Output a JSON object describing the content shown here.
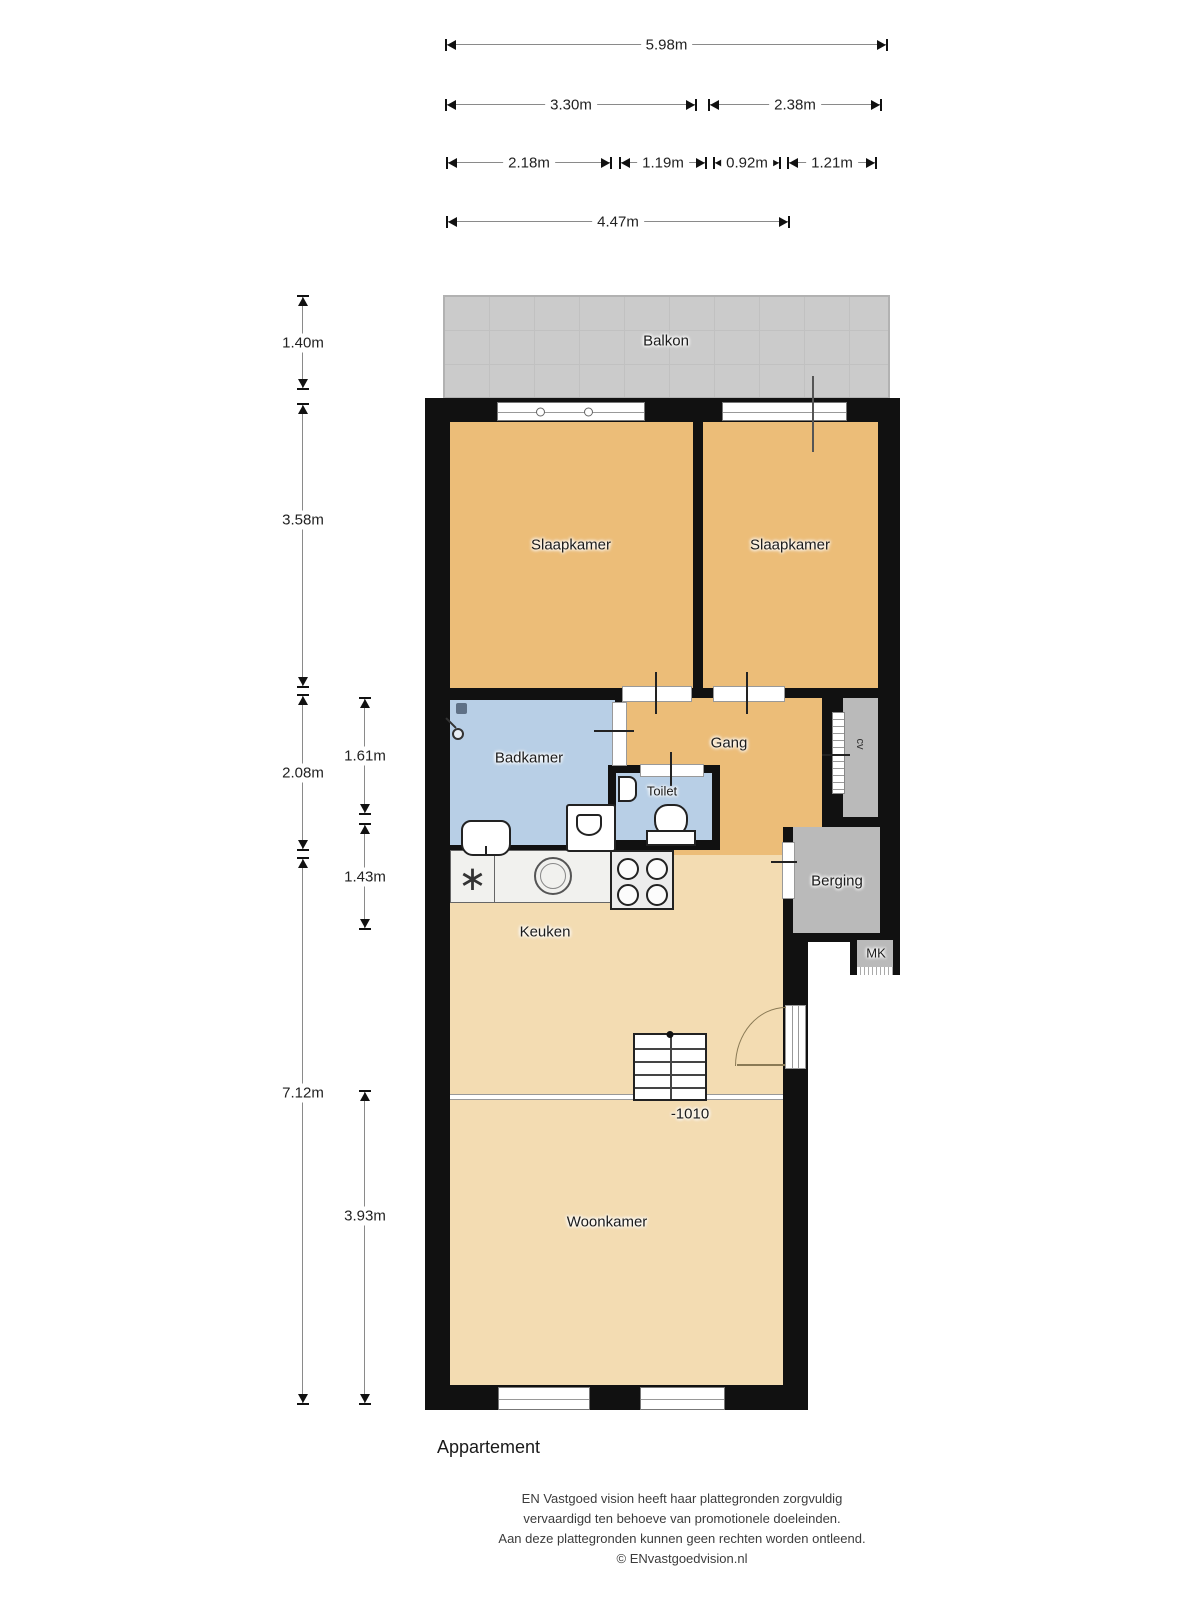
{
  "dimensions": {
    "top": [
      "5.98m",
      "3.30m",
      "2.38m",
      "2.18m",
      "1.19m",
      "0.92m",
      "1.21m",
      "4.47m"
    ],
    "left": [
      "1.40m",
      "3.58m",
      "2.08m",
      "7.12m"
    ],
    "left_inner": [
      "1.61m",
      "1.43m",
      "3.93m"
    ]
  },
  "rooms": {
    "balkon": "Balkon",
    "slaapkamer_left": "Slaapkamer",
    "slaapkamer_right": "Slaapkamer",
    "badkamer": "Badkamer",
    "toilet": "Toilet",
    "gang": "Gang",
    "cv": "cv",
    "berging": "Berging",
    "mk": "MK",
    "keuken": "Keuken",
    "woonkamer": "Woonkamer",
    "level_marker": "-1010"
  },
  "icons": {
    "freezer": "∗"
  },
  "footer": {
    "plan_title": "Appartement",
    "disclaimer": [
      "EN Vastgoed vision heeft haar plattegronden zorgvuldig",
      "vervaardigd ten behoeve van promotionele doeleinden.",
      "Aan deze plattegronden kunnen geen rechten worden ontleend.",
      "© ENvastgoedvision.nl"
    ]
  },
  "colors": {
    "room_orange": "#ecbd78",
    "room_tan": "#f3dcb2",
    "room_blue": "#b8cfe6",
    "balkon_gray": "#cbcbcb",
    "storage_gray": "#bababa",
    "wall_black": "#111111"
  }
}
